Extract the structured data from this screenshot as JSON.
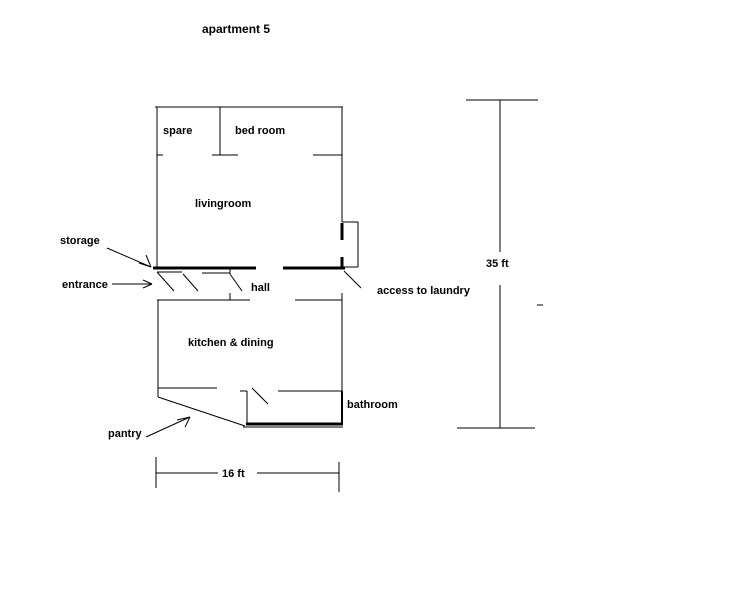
{
  "title": "apartment 5",
  "rooms": {
    "spare": "spare",
    "bedroom": "bed room",
    "livingroom": "livingroom",
    "hall": "hall",
    "kitchen_dining": "kitchen & dining",
    "bathroom": "bathroom"
  },
  "annotations": {
    "storage": "storage",
    "entrance": "entrance",
    "laundry": "access to laundry",
    "pantry": "pantry"
  },
  "dimensions": {
    "height_label": "35 ft",
    "width_label": "16 ft"
  },
  "colors": {
    "line": "#000000",
    "background": "#ffffff"
  }
}
